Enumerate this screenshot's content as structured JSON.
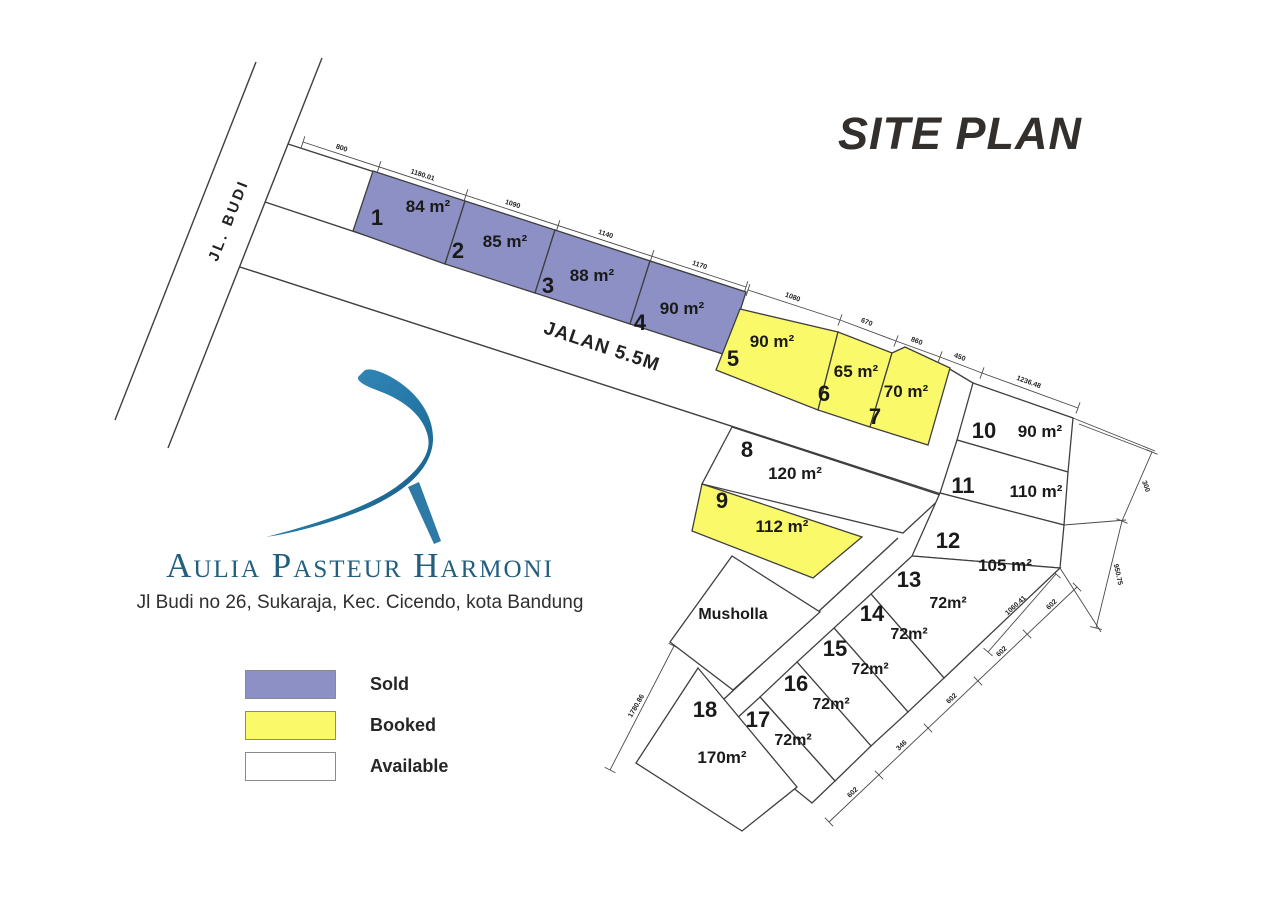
{
  "title": "SITE PLAN",
  "brand": {
    "name": "Aulia Pasteur Harmoni",
    "address": "Jl Budi no 26, Sukaraja, Kec. Cicendo, kota Bandung"
  },
  "legend": {
    "items": [
      {
        "label": "Sold",
        "status": "sold"
      },
      {
        "label": "Booked",
        "status": "booked"
      },
      {
        "label": "Available",
        "status": "available"
      }
    ]
  },
  "colors": {
    "sold": "#8c90c5",
    "booked": "#faf969",
    "available": "#ffffff",
    "line": "#3f3f3f",
    "dim": "#4a4a4a",
    "label": "#1a1a1a",
    "brand_text": "#235e7f",
    "logo_blue_light": "#3d92c4",
    "logo_blue_dark": "#14567e"
  },
  "roads": {
    "jl_budi": {
      "label": "JL.  BUDI",
      "x": 233,
      "y": 222,
      "rot": -68.6
    },
    "jalan": {
      "label": "JALAN 5.5M",
      "x": 600,
      "y": 352,
      "rot": 18.5
    }
  },
  "facilities": [
    {
      "label": "Musholla",
      "points": "670,642 732,556 820,612 733,690",
      "lx": 733,
      "ly": 619
    }
  ],
  "plots": [
    {
      "no": "1",
      "area": "84 m²",
      "status": "sold",
      "points": "373,171 465,201 445,264 353,231",
      "nx": 377,
      "ny": 225,
      "ax": 428,
      "ay": 212
    },
    {
      "no": "2",
      "area": "85 m²",
      "status": "sold",
      "points": "465,201 555,230 535,293 445,264",
      "nx": 458,
      "ny": 258,
      "ax": 505,
      "ay": 247
    },
    {
      "no": "3",
      "area": "88 m²",
      "status": "sold",
      "points": "555,230 650,261 630,324 535,293",
      "nx": 548,
      "ny": 293,
      "ax": 592,
      "ay": 281
    },
    {
      "no": "4",
      "area": "90 m²",
      "status": "sold",
      "points": "650,261 746,292 726,355 630,324",
      "nx": 640,
      "ny": 330,
      "ax": 682,
      "ay": 314
    },
    {
      "no": "5",
      "area": "90 m²",
      "status": "booked",
      "points": "740,309 838,332 818,410 716,370",
      "nx": 733,
      "ny": 366,
      "ax": 772,
      "ay": 347
    },
    {
      "no": "6",
      "area": "65 m²",
      "status": "booked",
      "points": "838,332 892,353 870,427 818,410",
      "nx": 824,
      "ny": 401,
      "ax": 856,
      "ay": 377
    },
    {
      "no": "7",
      "area": "70 m²",
      "status": "booked",
      "points": "892,353 905,347 950,368 928,445 870,427",
      "nx": 875,
      "ny": 424,
      "ax": 906,
      "ay": 397
    },
    {
      "no": "8",
      "area": "120 m²",
      "status": "available",
      "points": "732,427 943,496 903,533 702,484",
      "nx": 747,
      "ny": 457,
      "ax": 795,
      "ay": 479
    },
    {
      "no": "9",
      "area": "112 m²",
      "status": "booked",
      "points": "702,484 862,537 813,578 692,531",
      "nx": 722,
      "ny": 508,
      "ax": 782,
      "ay": 532
    },
    {
      "no": "10",
      "area": "90 m²",
      "status": "available",
      "points": "973,383 1073,418 1068,472 957,440",
      "nx": 984,
      "ny": 438,
      "ax": 1040,
      "ay": 437
    },
    {
      "no": "11",
      "area": "110 m²",
      "status": "available",
      "points": "957,440 1068,472 1064,525 940,493",
      "nx": 963,
      "ny": 493,
      "ax": 1036,
      "ay": 497
    },
    {
      "no": "12",
      "area": "105 m²",
      "status": "available",
      "points": "940,493 1064,525 1060,568 912,556",
      "nx": 948,
      "ny": 548,
      "ax": 1005,
      "ay": 571
    },
    {
      "no": "13",
      "area": "72m²",
      "status": "available",
      "points": "912,556 1060,568 944,678 871,594",
      "nx": 909,
      "ny": 587,
      "ax": 948,
      "ay": 608
    },
    {
      "no": "14",
      "area": "72m²",
      "status": "available",
      "points": "871,594 944,678 908,712 834,628",
      "nx": 872,
      "ny": 621,
      "ax": 909,
      "ay": 639
    },
    {
      "no": "15",
      "area": "72m²",
      "status": "available",
      "points": "834,628 908,712 871,746 797,662",
      "nx": 835,
      "ny": 656,
      "ax": 870,
      "ay": 674
    },
    {
      "no": "16",
      "area": "72m²",
      "status": "available",
      "points": "797,662 871,746 835,781 760,697",
      "nx": 796,
      "ny": 691,
      "ax": 831,
      "ay": 709
    },
    {
      "no": "17",
      "area": "72m²",
      "status": "available",
      "points": "760,697 835,781 812,803 723,731",
      "nx": 758,
      "ny": 727,
      "ax": 793,
      "ay": 745
    },
    {
      "no": "18",
      "area": "170m²",
      "status": "available",
      "points": "698,668 797,787 742,831 636,763",
      "nx": 705,
      "ny": 717,
      "ax": 722,
      "ay": 763
    }
  ],
  "dimension_labels": [
    {
      "t": "800",
      "x": 341,
      "y": 150,
      "r": 18
    },
    {
      "t": "1180.01",
      "x": 422,
      "y": 177,
      "r": 18
    },
    {
      "t": "1090",
      "x": 512,
      "y": 206,
      "r": 18
    },
    {
      "t": "1140",
      "x": 605,
      "y": 236,
      "r": 18
    },
    {
      "t": "1170",
      "x": 699,
      "y": 267,
      "r": 18
    },
    {
      "t": "1080",
      "x": 792,
      "y": 299,
      "r": 20
    },
    {
      "t": "670",
      "x": 866,
      "y": 324,
      "r": 21
    },
    {
      "t": "860",
      "x": 916,
      "y": 343,
      "r": 21
    },
    {
      "t": "450",
      "x": 959,
      "y": 359,
      "r": 21
    },
    {
      "t": "1236.48",
      "x": 1028,
      "y": 384,
      "r": 20
    },
    {
      "t": "300",
      "x": 1144,
      "y": 487,
      "r": 70
    },
    {
      "t": "950.75",
      "x": 1116,
      "y": 575,
      "r": 77
    },
    {
      "t": "1060.41",
      "x": 1017,
      "y": 607,
      "r": -42
    },
    {
      "t": "602",
      "x": 1053,
      "y": 606,
      "r": -43
    },
    {
      "t": "602",
      "x": 1003,
      "y": 653,
      "r": -43
    },
    {
      "t": "602",
      "x": 953,
      "y": 700,
      "r": -43
    },
    {
      "t": "346",
      "x": 903,
      "y": 747,
      "r": -43
    },
    {
      "t": "602",
      "x": 854,
      "y": 794,
      "r": -43
    },
    {
      "t": "1780.86",
      "x": 638,
      "y": 707,
      "r": -60
    }
  ]
}
